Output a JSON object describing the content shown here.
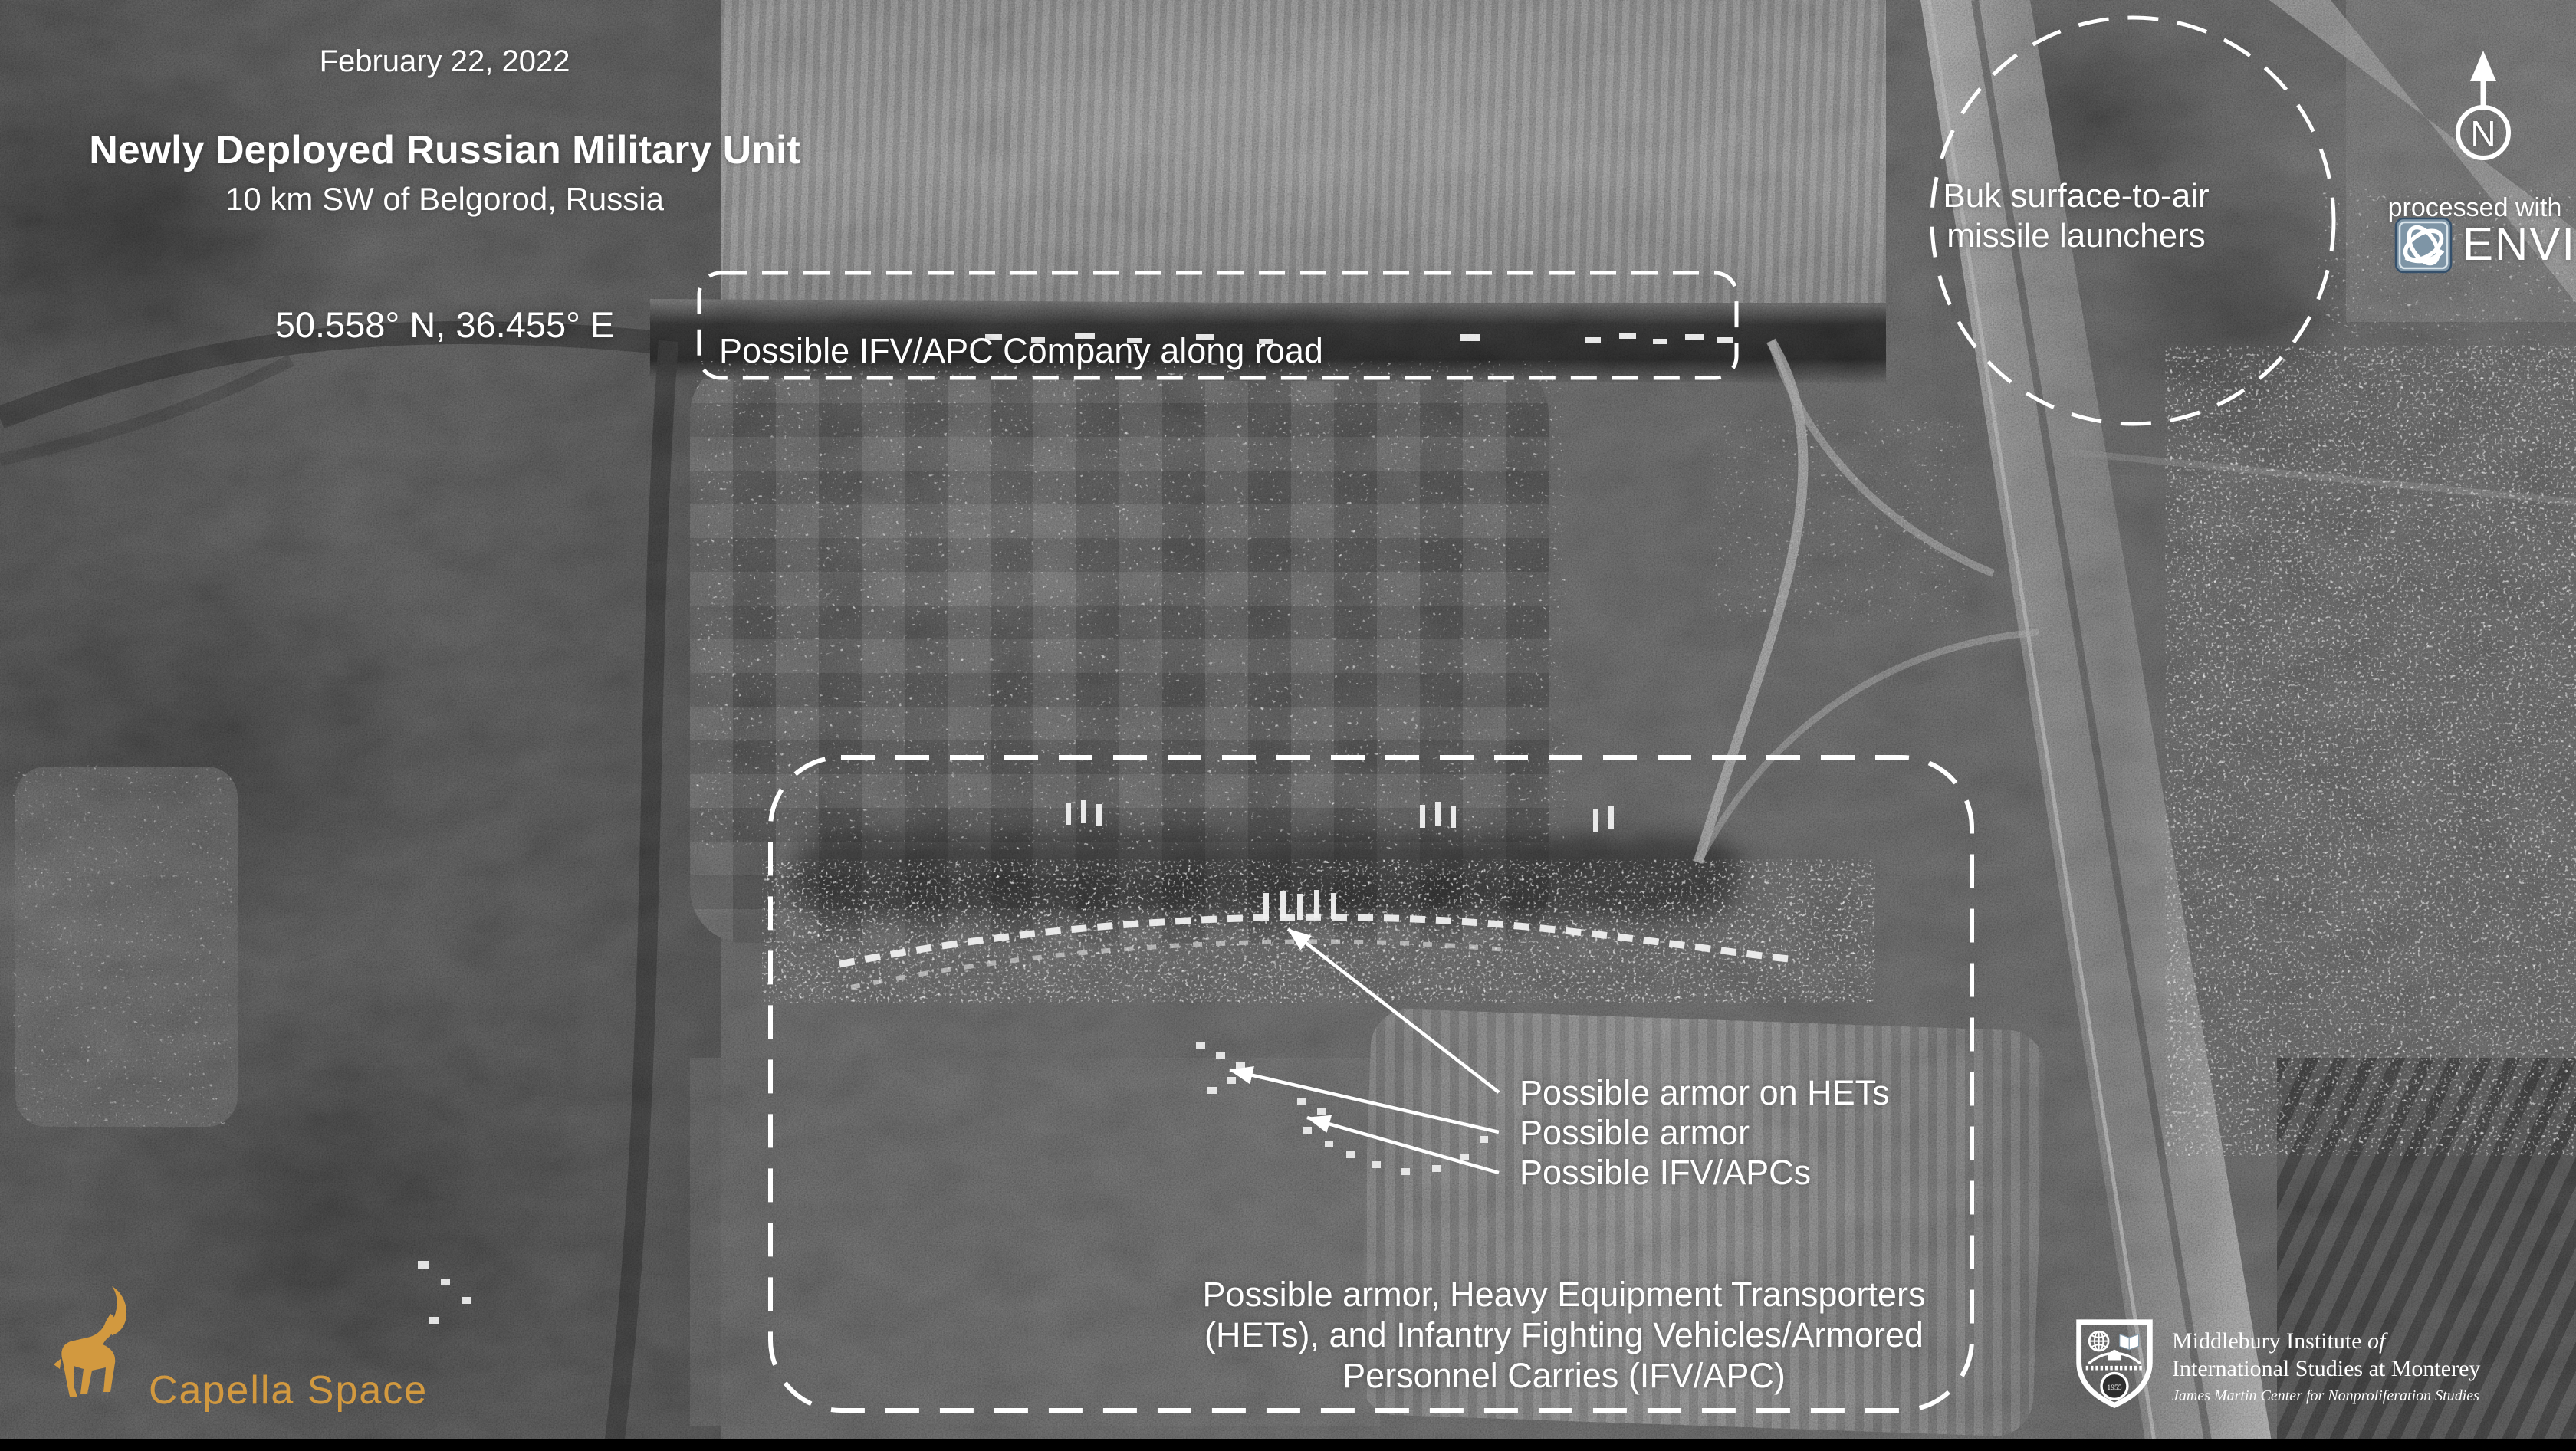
{
  "header": {
    "date": "February 22, 2022",
    "title": "Newly Deployed Russian Military Unit",
    "subtitle": "10 km SW of Belgorod, Russia",
    "coordinates": "50.558° N, 36.455° E"
  },
  "road_box": {
    "label": "Possible IFV/APC Company along road"
  },
  "buk": {
    "line1": "Buk surface-to-air",
    "line2": "missile launchers"
  },
  "pointers": {
    "items": [
      "Possible armor on HETs",
      "Possible armor",
      "Possible IFV/APCs"
    ]
  },
  "assembly": {
    "line1": "Possible armor, Heavy Equipment Transporters",
    "line2": "(HETs), and Infantry Fighting Vehicles/Armored",
    "line3": "Personnel Carries (IFV/APC)"
  },
  "compass": {
    "letter": "N"
  },
  "processing": {
    "prefix": "processed with",
    "brand": "ENVI"
  },
  "capella": {
    "wordmark": "Capella Space"
  },
  "middlebury": {
    "line1": "Middlebury Institute ",
    "line1_suffix": "of",
    "line2": "International Studies at Monterey",
    "line3": "James Martin Center for Nonproliferation Studies",
    "year": "1955"
  },
  "colors": {
    "annotation_white": "#FFFFFF",
    "capella_orange": "#D2993F",
    "envi_icon_blue": "#7E95A6",
    "background_gray": "#4F4F4F"
  }
}
